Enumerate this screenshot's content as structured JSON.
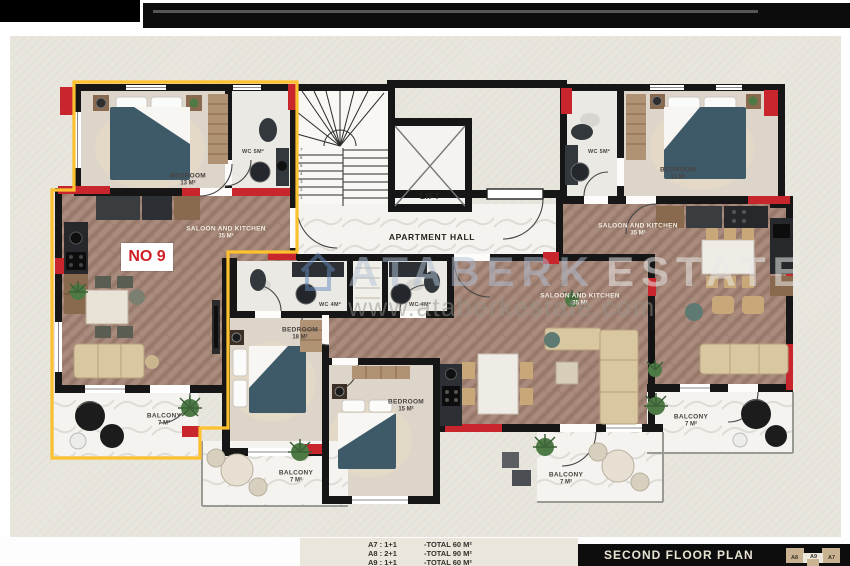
{
  "watermark": {
    "brand_left": "ATABERK",
    "brand_right": "ESTATE",
    "url": "www.ataberkestate.com"
  },
  "core": {
    "lift_label": "LIFT",
    "hall_label": "APARTMENT HALL"
  },
  "badge": {
    "unit_no": "NO 9"
  },
  "rooms": {
    "a9_bedroom": {
      "name": "BEDROOM",
      "area": "13 M²"
    },
    "a9_wc": {
      "name": "WC 5M²"
    },
    "a9_saloon": {
      "name": "SALOON AND KITCHEN",
      "area": "35 M²"
    },
    "a9_balcony": {
      "name": "BALCONY",
      "area": "7 M²"
    },
    "a8_wc_left": {
      "name": "WC 4M²"
    },
    "a8_wc_right": {
      "name": "WC 4M²"
    },
    "a8_bedroom_18": {
      "name": "BEDROOM",
      "area": "18 M²"
    },
    "a8_bedroom_15": {
      "name": "BEDROOM",
      "area": "15 M²"
    },
    "a8_saloon": {
      "name": "SALOON AND KITCHEN",
      "area": "35 M²"
    },
    "a8_balcony_left": {
      "name": "BALCONY",
      "area": "7 M²"
    },
    "a8_balcony_right": {
      "name": "BALCONY",
      "area": "7 M²"
    },
    "a7_wc": {
      "name": "WC 5M²"
    },
    "a7_bedroom": {
      "name": "BEDROOM",
      "area": "13 M²"
    },
    "a7_saloon": {
      "name": "SALOON AND KITCHEN",
      "area": "35 M²"
    },
    "a7_balcony": {
      "name": "BALCONY",
      "area": "7 M²"
    }
  },
  "stairs": {
    "numbers": [
      "1",
      "2",
      "3",
      "4",
      "5",
      "6",
      "7"
    ]
  },
  "legend": {
    "rows": [
      {
        "unit": "A7 : 1+1",
        "total": "-TOTAL  60 M²"
      },
      {
        "unit": "A8 : 2+1",
        "total": "-TOTAL  90 M²"
      },
      {
        "unit": "A9 : 1+1",
        "total": "-TOTAL  60 M²"
      }
    ]
  },
  "footer": {
    "title": "SECOND FLOOR PLAN",
    "thumb_labels": [
      "A8",
      "A9",
      "A7"
    ]
  },
  "colors": {
    "highlight_yellow": "#fdc02f",
    "accent_red": "#c8252c",
    "bed_teal": "#3e5a68",
    "wood_floor": "#a28273",
    "wall_black": "#161616",
    "plan_background": "#e8e5dd"
  }
}
